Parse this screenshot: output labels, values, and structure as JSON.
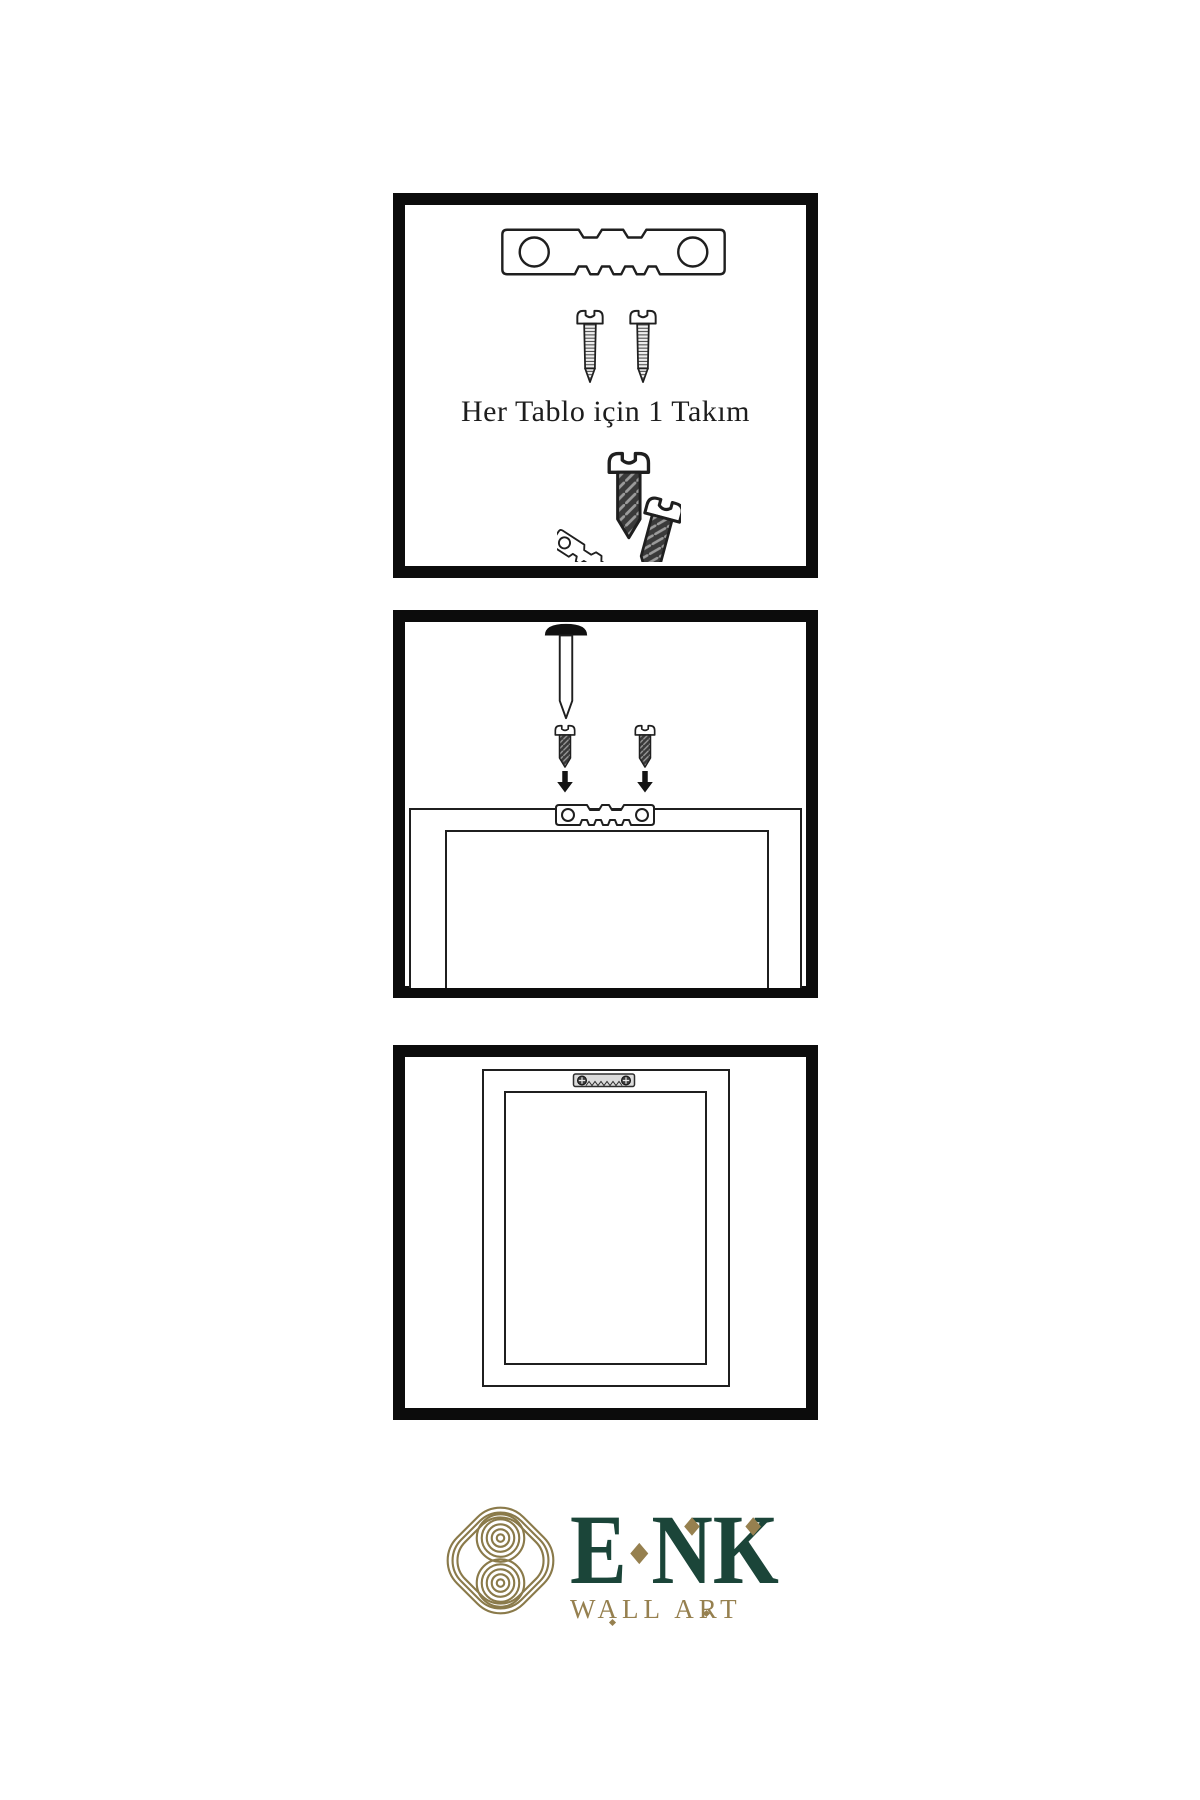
{
  "page": {
    "width": 1200,
    "height": 1800,
    "background": "#ffffff"
  },
  "colors": {
    "line": "#1f1f1f",
    "panel_border": "#0c0c0c",
    "dark_screw_fill": "#3a3a3a",
    "mounted_hanger_fill": "#dcdcdc",
    "logo_green": "#1b4539",
    "logo_gold": "#96804f",
    "knot_gold": "#8a7a4a"
  },
  "panels": {
    "kit": {
      "caption": "Her Tablo için 1 Takım",
      "icons": [
        "sawtooth-hanger-icon",
        "screw-icon",
        "screw-icon",
        "angled-hanger-with-screws-icon"
      ]
    },
    "mounting": {
      "icons": [
        "nail-icon",
        "dark-screw-icon",
        "dark-screw-icon",
        "arrow-down-icon",
        "arrow-down-icon",
        "frame-back-icon",
        "sawtooth-hanger-icon"
      ]
    },
    "hanging": {
      "icons": [
        "frame-back-icon",
        "mounted-sawtooth-hanger-icon"
      ]
    }
  },
  "logo": {
    "letters": [
      "E",
      "N",
      "K"
    ],
    "subtitle": "WALL ART"
  }
}
